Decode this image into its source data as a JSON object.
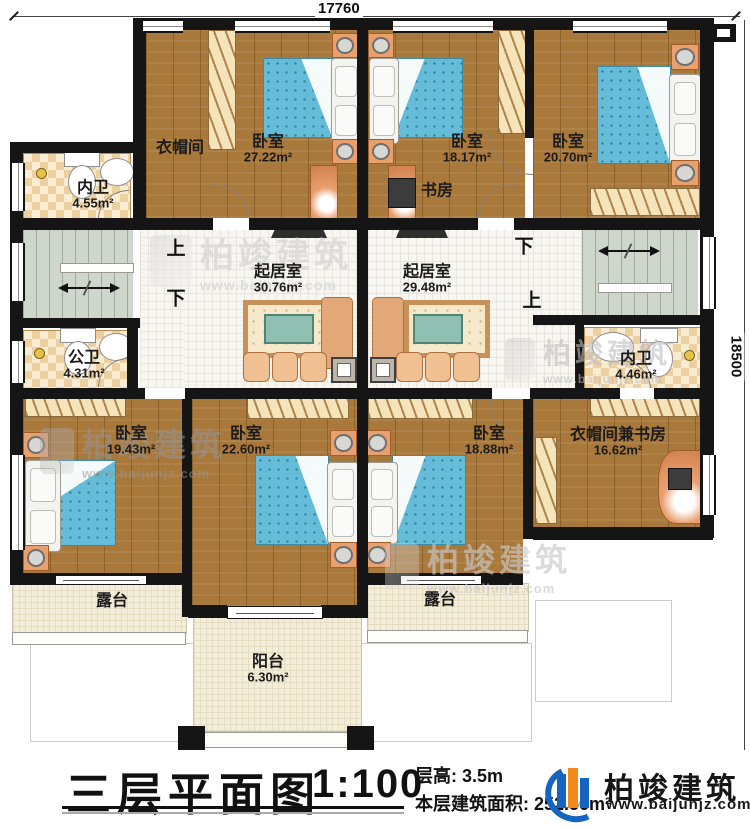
{
  "dimensions": {
    "top": "17760",
    "right": "18500"
  },
  "rooms": {
    "nw1": {
      "name": "内卫",
      "area": "4.55m²"
    },
    "ym": {
      "name": "衣帽间",
      "area": ""
    },
    "b2722": {
      "name": "卧室",
      "area": "27.22m²"
    },
    "b1817": {
      "name": "卧室",
      "area": "18.17m²"
    },
    "sf": {
      "name": "书房",
      "area": ""
    },
    "b2070": {
      "name": "卧室",
      "area": "20.70m²"
    },
    "lr1": {
      "name": "起居室",
      "area": "30.76m²"
    },
    "lr2": {
      "name": "起居室",
      "area": "29.48m²"
    },
    "gw": {
      "name": "公卫",
      "area": "4.31m²"
    },
    "nw2": {
      "name": "内卫",
      "area": "4.46m²"
    },
    "b1943": {
      "name": "卧室",
      "area": "19.43m²"
    },
    "b2260": {
      "name": "卧室",
      "area": "22.60m²"
    },
    "b1888": {
      "name": "卧室",
      "area": "18.88m²"
    },
    "ymsf": {
      "name": "衣帽间兼书房",
      "area": "16.62m²"
    },
    "lt": {
      "name": "露台",
      "area": ""
    },
    "rt": {
      "name": "露台",
      "area": ""
    },
    "yt": {
      "name": "阳台",
      "area": "6.30m²"
    }
  },
  "stairs": {
    "up": "上",
    "down": "下"
  },
  "title_block": {
    "title": "三层平面图",
    "scale": "1:100",
    "floor_height": "层高: 3.5m",
    "floor_area": "本层建筑面积: 252.56m²"
  },
  "brand": {
    "name": "柏竣建筑",
    "site": "www.baijunjz.com"
  },
  "colors": {
    "wall": "#151515",
    "wood": "#a9793c",
    "mattress": "#65bcd9",
    "logo_blue": "#1565c0",
    "logo_orange": "#f28a1e"
  }
}
